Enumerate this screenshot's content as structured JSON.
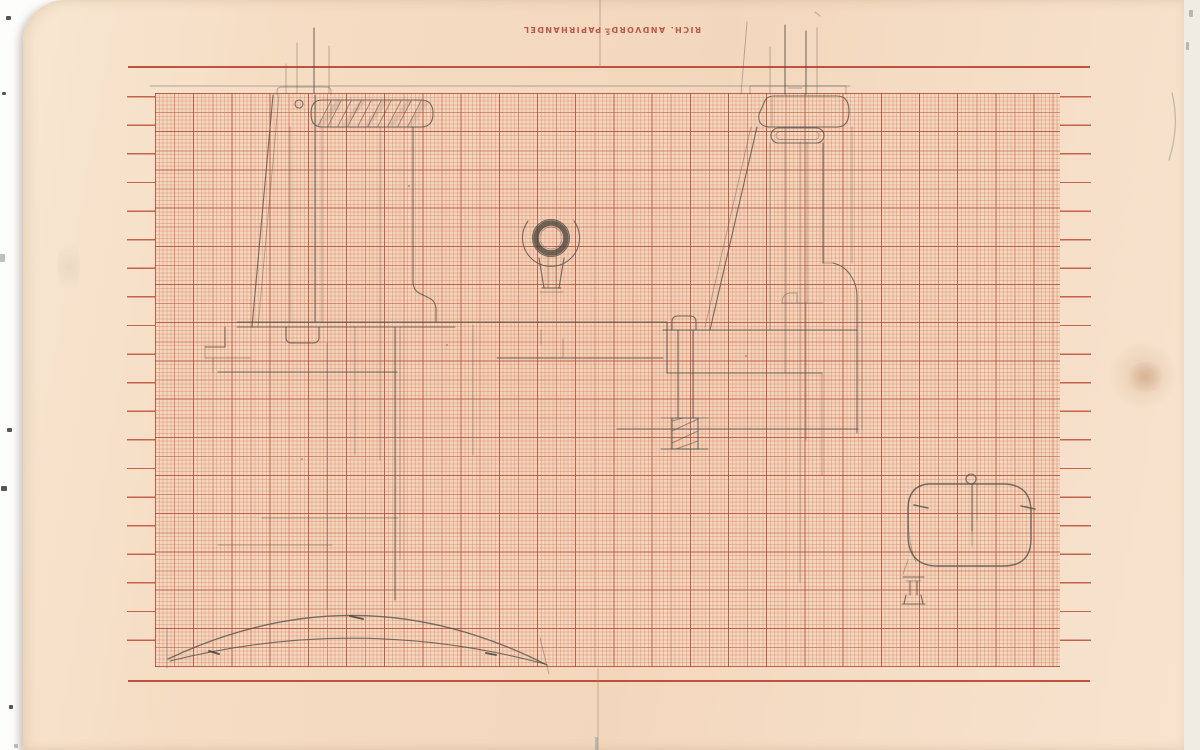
{
  "stamp": {
    "prefix": "RICH. ANDVORD",
    "superscript": "S",
    "suffix": " PAPIRHANDEL"
  },
  "colors": {
    "paper_margin": "#f6e0c9",
    "grid_paper": "#f4d8be",
    "grid_line_fine": "#cb6a52",
    "grid_line_major": "#a63728",
    "ruling_red": "#b8432e",
    "stamp_red": "#ab392a",
    "pencil": "#55514a"
  }
}
